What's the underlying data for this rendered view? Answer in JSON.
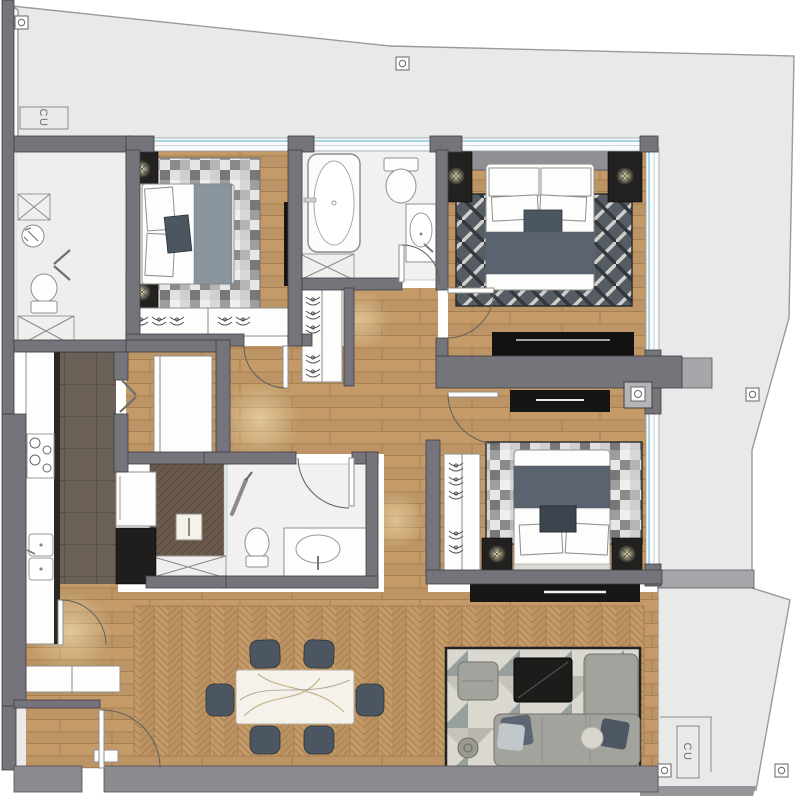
{
  "labels": {
    "cu_top": "CU",
    "cu_bottom": "CU"
  },
  "colors": {
    "balcony": "#e9e9ea",
    "wall": "#74747a",
    "wood": "#c49a69",
    "wood-line": "#a87f4e",
    "tile": "#6b6057",
    "tile-line": "#5a5148",
    "marble": "#f2f1ef",
    "shower": "#6a5a4c",
    "glass": "#aad6e4",
    "rug-master": "#565c64",
    "sofa": "#a3a39e",
    "slate": "#4b5661",
    "furn-dark": "#22211f",
    "white": "#fdfdfc",
    "glow": "#f2e9af"
  }
}
